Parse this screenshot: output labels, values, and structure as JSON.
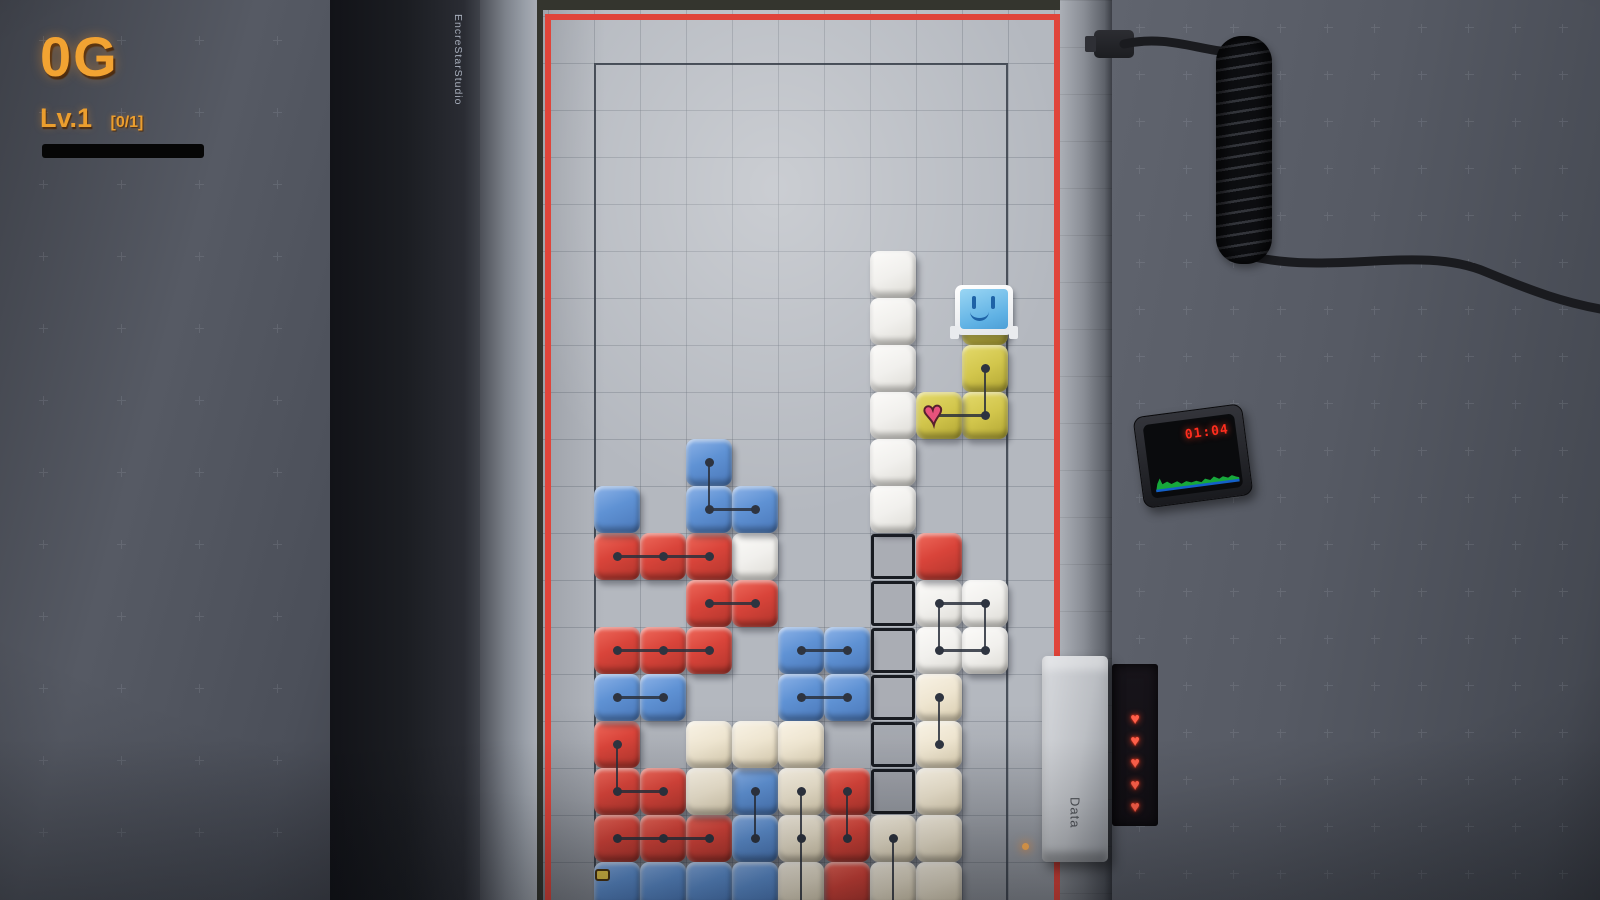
{
  "hud": {
    "score": "0G",
    "level": "Lv.1",
    "progress": "[0/1]"
  },
  "studio_label": "EncreStarStudio",
  "timer": {
    "time": "01:04"
  },
  "data_handle": {
    "label": "Data"
  },
  "lives": {
    "count": 5,
    "glyph": "♥",
    "icon": "heart"
  },
  "colors": {
    "frame_red": "#e0443a",
    "hud_amber": "#f2a332",
    "timer_red": "#ff2d1e",
    "wave_green": "#17a83b",
    "wave_blue": "#1460c8",
    "heart_life": "#ff604a",
    "key_red": "#d9443a",
    "key_blue": "#5f92d4",
    "key_white": "#f1f0ed",
    "key_cream": "#eee5d0",
    "key_yellow": "#d2c64c",
    "heart_block": "#e8527c"
  },
  "board": {
    "cols": 9,
    "rows": 18,
    "cell_w": 46,
    "cell_h": 47,
    "origin_x": 594,
    "origin_y": 63,
    "blocks": {
      "white": [
        [
          6,
          4
        ],
        [
          6,
          5
        ],
        [
          6,
          6
        ],
        [
          6,
          7
        ],
        [
          6,
          8
        ],
        [
          6,
          9
        ],
        [
          3,
          10
        ],
        [
          7,
          11
        ],
        [
          8,
          11
        ],
        [
          7,
          12
        ],
        [
          8,
          12
        ]
      ],
      "yellow": [
        [
          8,
          5
        ],
        [
          8,
          6
        ],
        [
          8,
          7
        ],
        [
          7,
          7
        ]
      ],
      "red": [
        [
          0,
          10
        ],
        [
          1,
          10
        ],
        [
          2,
          10
        ],
        [
          7,
          10
        ],
        [
          2,
          11
        ],
        [
          3,
          11
        ],
        [
          0,
          12
        ],
        [
          1,
          12
        ],
        [
          2,
          12
        ],
        [
          0,
          14
        ],
        [
          0,
          15
        ],
        [
          1,
          15
        ],
        [
          5,
          15
        ],
        [
          0,
          16
        ],
        [
          1,
          16
        ],
        [
          2,
          16
        ],
        [
          5,
          16
        ],
        [
          5,
          17
        ]
      ],
      "blue": [
        [
          2,
          8
        ],
        [
          0,
          9
        ],
        [
          2,
          9
        ],
        [
          3,
          9
        ],
        [
          4,
          12
        ],
        [
          5,
          12
        ],
        [
          0,
          13
        ],
        [
          1,
          13
        ],
        [
          4,
          13
        ],
        [
          5,
          13
        ],
        [
          3,
          15
        ],
        [
          3,
          16
        ],
        [
          0,
          17
        ],
        [
          1,
          17
        ],
        [
          2,
          17
        ],
        [
          3,
          17
        ]
      ],
      "cream": [
        [
          2,
          14
        ],
        [
          3,
          14
        ],
        [
          4,
          14
        ],
        [
          7,
          13
        ],
        [
          7,
          14
        ],
        [
          2,
          15
        ],
        [
          4,
          15
        ],
        [
          7,
          15
        ],
        [
          4,
          16
        ],
        [
          6,
          16
        ],
        [
          7,
          16
        ],
        [
          4,
          17
        ],
        [
          6,
          17
        ],
        [
          7,
          17
        ]
      ]
    },
    "ghost_cells": [
      [
        6,
        10
      ],
      [
        6,
        11
      ],
      [
        6,
        12
      ],
      [
        6,
        13
      ],
      [
        6,
        14
      ],
      [
        6,
        15
      ]
    ],
    "traces": {
      "dots": [
        [
          8,
          6
        ],
        [
          8,
          7
        ],
        [
          2,
          8
        ],
        [
          2,
          9
        ],
        [
          3,
          9
        ],
        [
          0,
          10
        ],
        [
          1,
          10
        ],
        [
          2,
          10
        ],
        [
          2,
          11
        ],
        [
          3,
          11
        ],
        [
          0,
          12
        ],
        [
          1,
          12
        ],
        [
          2,
          12
        ],
        [
          4,
          12
        ],
        [
          5,
          12
        ],
        [
          0,
          13
        ],
        [
          1,
          13
        ],
        [
          4,
          13
        ],
        [
          5,
          13
        ],
        [
          7,
          11
        ],
        [
          8,
          11
        ],
        [
          7,
          12
        ],
        [
          8,
          12
        ],
        [
          7,
          13
        ],
        [
          7,
          14
        ],
        [
          0,
          14
        ],
        [
          0,
          15
        ],
        [
          1,
          15
        ],
        [
          3,
          15
        ],
        [
          3,
          16
        ],
        [
          4,
          15
        ],
        [
          4,
          16
        ],
        [
          5,
          15
        ],
        [
          5,
          16
        ],
        [
          6,
          16
        ],
        [
          0,
          16
        ],
        [
          1,
          16
        ],
        [
          2,
          16
        ]
      ],
      "hlines": [
        [
          7,
          8,
          7
        ],
        [
          2,
          3,
          9
        ],
        [
          0,
          2,
          10
        ],
        [
          2,
          3,
          11
        ],
        [
          0,
          2,
          12
        ],
        [
          4,
          5,
          12
        ],
        [
          0,
          1,
          13
        ],
        [
          4,
          5,
          13
        ],
        [
          7,
          8,
          11
        ],
        [
          7,
          8,
          12
        ],
        [
          0,
          1,
          15
        ],
        [
          0,
          2,
          16
        ]
      ],
      "vlines": [
        [
          8,
          6,
          7
        ],
        [
          2,
          8,
          9
        ],
        [
          7,
          11,
          12
        ],
        [
          8,
          11,
          12
        ],
        [
          7,
          13,
          14
        ],
        [
          0,
          14,
          15
        ],
        [
          3,
          15,
          16
        ],
        [
          4,
          15,
          17.35
        ],
        [
          5,
          15,
          16
        ],
        [
          6,
          16,
          17.35
        ]
      ]
    },
    "heart_block": {
      "c": 7,
      "r": 7,
      "glyph": "♥"
    },
    "character_cell": {
      "c": 8,
      "r": 5
    }
  }
}
